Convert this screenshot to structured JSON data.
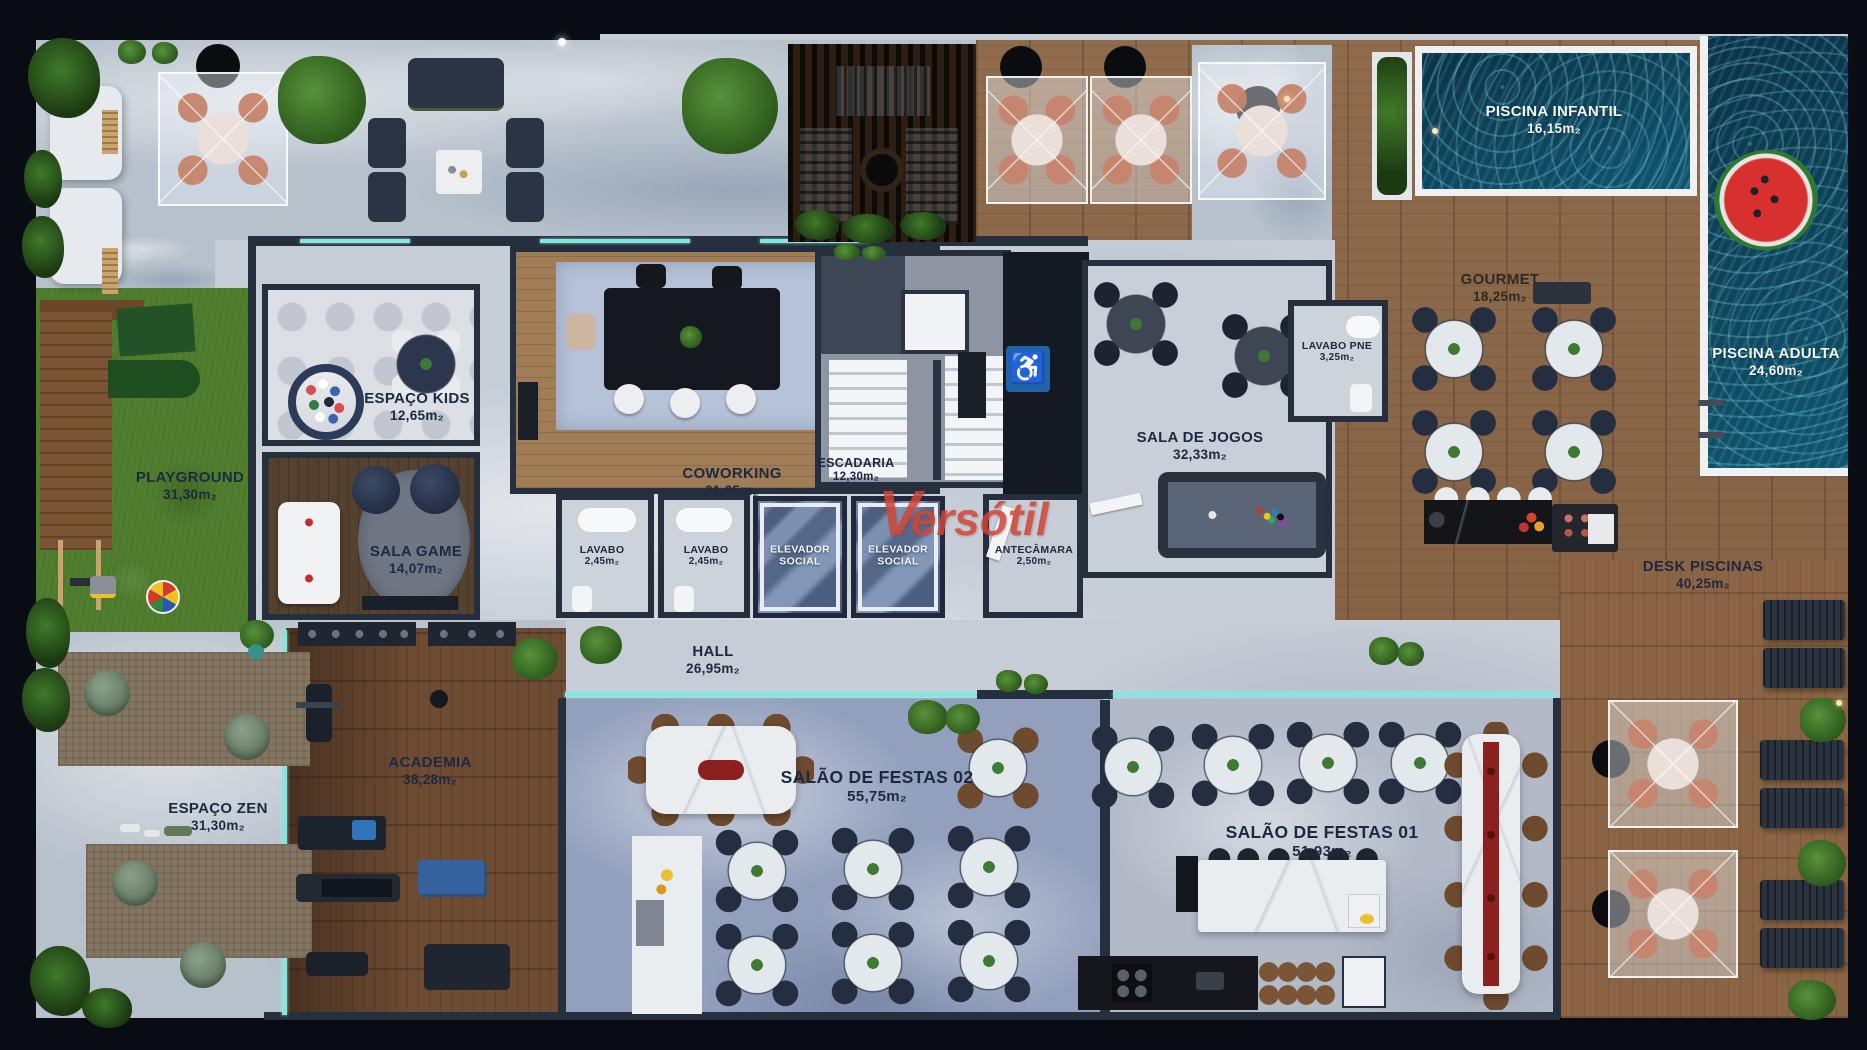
{
  "watermark": {
    "initial": "V",
    "text": "ersótil"
  },
  "icons": {
    "accessibility": "♿"
  },
  "colors": {
    "accent_red": "#cf4537",
    "water": "#0e4d66",
    "wood_deck": "#8a6444",
    "grass": "#507e2e",
    "wall": "#262f3e",
    "label_dark": "#1d2940",
    "label_light": "#f4f7fa",
    "glass": "#8ae4de"
  },
  "rooms": [
    {
      "id": "playground",
      "name": "PLAYGROUND",
      "area": "31,30m₂"
    },
    {
      "id": "espaco-kids",
      "name": "ESPAÇO KIDS",
      "area": "12,65m₂"
    },
    {
      "id": "sala-game",
      "name": "SALA GAME",
      "area": "14,07m₂"
    },
    {
      "id": "coworking",
      "name": "COWORKING",
      "area": "21,95m₂"
    },
    {
      "id": "escadaria",
      "name": "ESCADARIA",
      "area": "12,30m₂"
    },
    {
      "id": "lavabo-1",
      "name": "LAVABO",
      "area": "2,45m₂"
    },
    {
      "id": "lavabo-2",
      "name": "LAVABO",
      "area": "2,45m₂"
    },
    {
      "id": "elevador-1",
      "name": "ELEVADOR SOCIAL",
      "area": ""
    },
    {
      "id": "elevador-2",
      "name": "ELEVADOR SOCIAL",
      "area": ""
    },
    {
      "id": "antecamara",
      "name": "ANTECÂMARA",
      "area": "2,50m₂"
    },
    {
      "id": "sala-de-jogos",
      "name": "SALA DE JOGOS",
      "area": "32,33m₂"
    },
    {
      "id": "lavabo-pne",
      "name": "LAVABO PNE",
      "area": "3,25m₂"
    },
    {
      "id": "gourmet",
      "name": "GOURMET",
      "area": "18,25m₂"
    },
    {
      "id": "piscina-infantil",
      "name": "PISCINA INFANTIL",
      "area": "16,15m₂"
    },
    {
      "id": "piscina-adulta",
      "name": "PISCINA ADULTA",
      "area": "24,60m₂"
    },
    {
      "id": "desk-piscinas",
      "name": "DESK PISCINAS",
      "area": "40,25m₂"
    },
    {
      "id": "hall",
      "name": "HALL",
      "area": "26,95m₂"
    },
    {
      "id": "academia",
      "name": "ACADEMIA",
      "area": "38,28m₂"
    },
    {
      "id": "espaco-zen",
      "name": "ESPAÇO ZEN",
      "area": "31,30m₂"
    },
    {
      "id": "salao-festas-02",
      "name": "SALÃO DE FESTAS 02",
      "area": "55,75m₂"
    },
    {
      "id": "salao-festas-01",
      "name": "SALÃO DE FESTAS 01",
      "area": "51,93m₂"
    }
  ]
}
